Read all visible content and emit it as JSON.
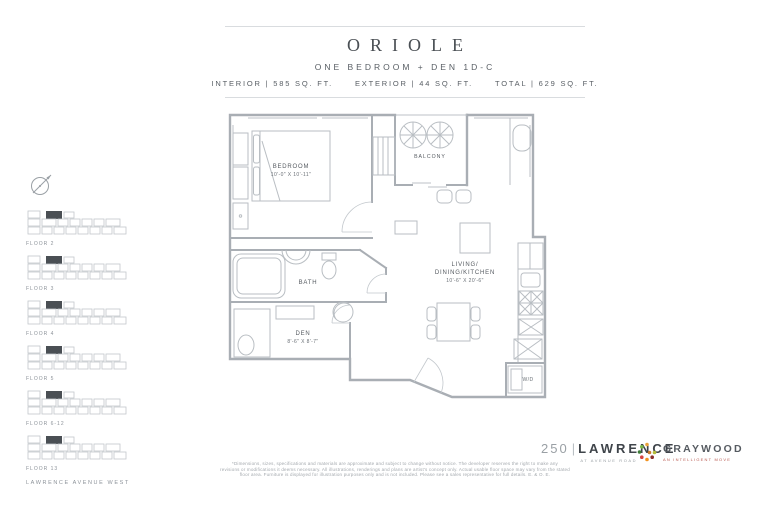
{
  "header": {
    "title": "ORIOLE",
    "subtitle": "ONE BEDROOM + DEN 1D-C",
    "stats": [
      "INTERIOR | 585 SQ. FT.",
      "EXTERIOR | 44 SQ. FT.",
      "TOTAL | 629 SQ. FT."
    ]
  },
  "sidebar": {
    "compass_icon": "north-arrow",
    "keyplans": [
      {
        "label": "FLOOR 2"
      },
      {
        "label": "FLOOR 3"
      },
      {
        "label": "FLOOR 4"
      },
      {
        "label": "FLOOR 5"
      },
      {
        "label": "FLOOR 6-12"
      },
      {
        "label": "FLOOR 13"
      }
    ],
    "street_label": "LAWRENCE AVENUE WEST"
  },
  "plan": {
    "rooms": {
      "bedroom": {
        "name": "BEDROOM",
        "dims": "10'-0\" X 10'-11\""
      },
      "bath": {
        "name": "BATH"
      },
      "den": {
        "name": "DEN",
        "dims": "8'-6\" X 8'-7\""
      },
      "living": {
        "line1": "LIVING/",
        "line2": "DINING/KITCHEN",
        "dims": "10'-6\" X 20'-6\""
      },
      "balcony": {
        "name": "BALCONY"
      },
      "laundry": {
        "name": "W/D"
      }
    }
  },
  "footer": {
    "disclaimer": [
      "*Dimensions, sizes, specifications and materials are approximate and subject to change without notice. The developer reserves the right to make any",
      "revisions or modifications it deems necessary. All illustrations, renderings and plans are artist's concept only. Actual usable floor space may vary from the stated",
      "floor area. Furniture is displayed for illustration purposes only and is not included. Please see a sales representative for full details. E. & O. E."
    ],
    "brand": {
      "number": "250",
      "name": "LAWRENCE",
      "tagline": "AT AVENUE ROAD"
    },
    "developer": {
      "name": "GRAYWOOD",
      "tagline": "AN INTELLIGENT MOVE"
    }
  },
  "colors": {
    "line": "#a9aeb4",
    "text": "#4a4f54",
    "highlight": "#4a4f54",
    "accent_red": "#b8574e"
  }
}
